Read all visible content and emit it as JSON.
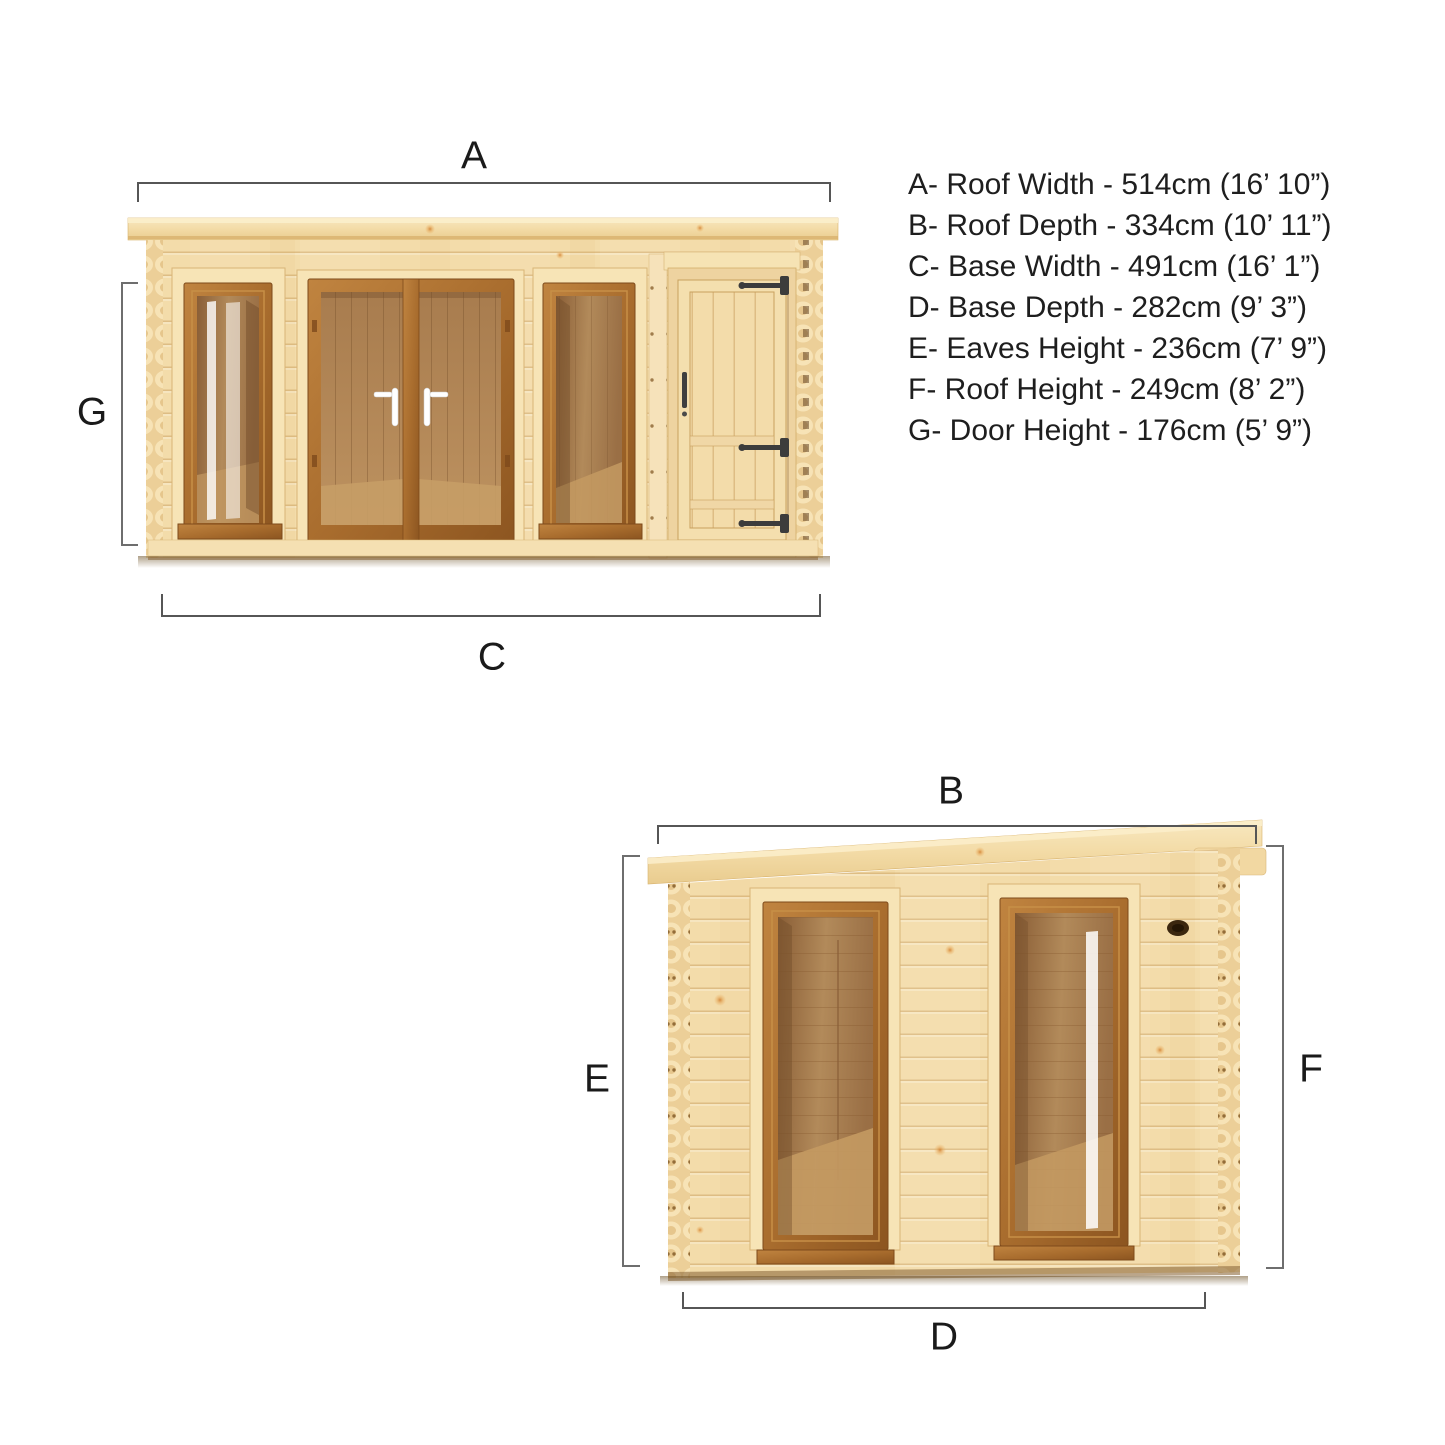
{
  "page": {
    "background": "#ffffff",
    "description_labels": [
      "A",
      "B",
      "C",
      "D",
      "E",
      "F",
      "G"
    ]
  },
  "labels": {
    "a": "A",
    "b": "B",
    "c": "C",
    "d": "D",
    "e": "E",
    "f": "F",
    "g": "G"
  },
  "dimension_key": {
    "lines": [
      "A- Roof Width - 514cm (16’ 10”)",
      "B- Roof Depth - 334cm (10’ 11”)",
      "C- Base Width - 491cm (16’ 1”)",
      "D- Base Depth - 282cm (9’ 3”)",
      "E- Eaves Height - 236cm (7’ 9”)",
      "F- Roof Height - 249cm (8’ 2”)",
      "G- Door Height - 176cm (5’ 9”)"
    ],
    "measurements": [
      {
        "label": "A",
        "name": "Roof Width",
        "cm": 514,
        "imperial": "16’ 10”"
      },
      {
        "label": "B",
        "name": "Roof Depth",
        "cm": 334,
        "imperial": "10’ 11”"
      },
      {
        "label": "C",
        "name": "Base Width",
        "cm": 491,
        "imperial": "16’ 1”"
      },
      {
        "label": "D",
        "name": "Base Depth",
        "cm": 282,
        "imperial": "9’ 3”"
      },
      {
        "label": "E",
        "name": "Eaves Height",
        "cm": 236,
        "imperial": "7’ 9”"
      },
      {
        "label": "F",
        "name": "Roof Height",
        "cm": 249,
        "imperial": "8’ 2”"
      },
      {
        "label": "G",
        "name": "Door Height",
        "cm": 176,
        "imperial": "5’ 9”"
      }
    ]
  },
  "colors": {
    "wall_pine": "#f3dcaa",
    "roof_pine": "#f3dba6",
    "trim_light": "#f7e4b6",
    "oak_frame": "#a96d2e",
    "glass_interior": "#b28a5a",
    "hinge_black": "#3c3c3c",
    "dimension_line": "#5c5c5c",
    "text": "#1e1e1e"
  }
}
